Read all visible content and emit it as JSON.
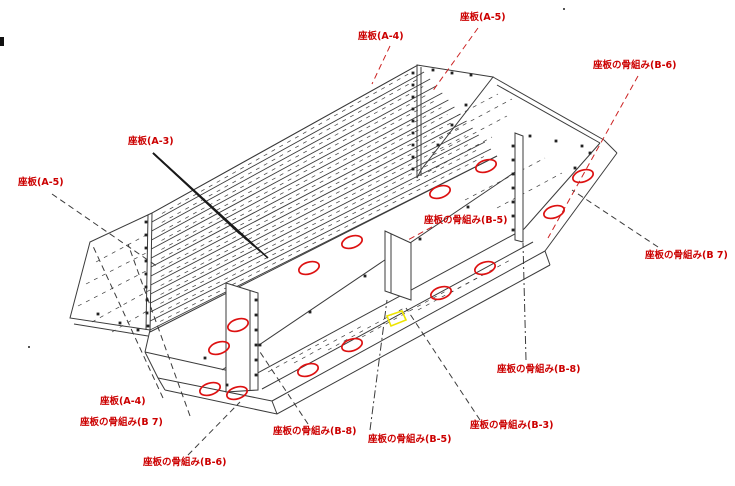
{
  "diagram": {
    "type": "isometric-assembly-drawing",
    "subject": "seat board framework assembly",
    "background": "#ffffff"
  },
  "colors": {
    "line": "#3b3b3b",
    "label": "#cc0000",
    "leader_red": "#cc2222",
    "ellipse": "#dd1111",
    "highlight": "#ede400"
  },
  "labels": [
    {
      "id": "zaban-a4-top",
      "text": "座板(A-4)",
      "x": 358,
      "y": 31
    },
    {
      "id": "zaban-a5-top",
      "text": "座板(A-5)",
      "x": 460,
      "y": 12
    },
    {
      "id": "honegumi-b6-top",
      "text": "座板の骨組み(B-6)",
      "x": 593,
      "y": 60
    },
    {
      "id": "zaban-a3",
      "text": "座板(A-3)",
      "x": 128,
      "y": 136
    },
    {
      "id": "zaban-a5-left",
      "text": "座板(A-5)",
      "x": 18,
      "y": 177
    },
    {
      "id": "honegumi-b5-top",
      "text": "座板の骨組み(B-5)",
      "x": 424,
      "y": 215
    },
    {
      "id": "honegumi-b7-right",
      "text": "座板の骨組み(B 7)",
      "x": 645,
      "y": 250
    },
    {
      "id": "honegumi-b8-right",
      "text": "座板の骨組み(B-8)",
      "x": 497,
      "y": 364
    },
    {
      "id": "zaban-a4-bottom",
      "text": "座板(A-4)",
      "x": 100,
      "y": 396
    },
    {
      "id": "honegumi-b7-bottom",
      "text": "座板の骨組み(B 7)",
      "x": 80,
      "y": 417
    },
    {
      "id": "honegumi-b6-bottom",
      "text": "座板の骨組み(B-6)",
      "x": 143,
      "y": 457
    },
    {
      "id": "honegumi-b8-bottom",
      "text": "座板の骨組み(B-8)",
      "x": 273,
      "y": 426
    },
    {
      "id": "honegumi-b5-bottom",
      "text": "座板の骨組み(B-5)",
      "x": 368,
      "y": 434
    },
    {
      "id": "honegumi-b3-bottom",
      "text": "座板の骨組み(B-3)",
      "x": 470,
      "y": 420
    }
  ],
  "leaders": [
    {
      "for": "zaban-a4-top",
      "x1": 390,
      "y1": 46,
      "x2": 372,
      "y2": 84,
      "color": "red",
      "style": "dashed"
    },
    {
      "for": "zaban-a5-top",
      "x1": 478,
      "y1": 28,
      "x2": 432,
      "y2": 92,
      "color": "red",
      "style": "dashed"
    },
    {
      "for": "honegumi-b6-top",
      "x1": 638,
      "y1": 76,
      "x2": 548,
      "y2": 238,
      "color": "red",
      "style": "dashed"
    },
    {
      "for": "honegumi-b5-top",
      "x1": 432,
      "y1": 227,
      "x2": 406,
      "y2": 241,
      "color": "red",
      "style": "dashed"
    },
    {
      "for": "zaban-a5-left",
      "x1": 52,
      "y1": 194,
      "x2": 158,
      "y2": 267,
      "color": "black",
      "style": "dashed"
    },
    {
      "for": "honegumi-b7-right",
      "x1": 658,
      "y1": 247,
      "x2": 572,
      "y2": 190,
      "color": "black",
      "style": "dashed"
    },
    {
      "for": "honegumi-b8-right",
      "x1": 526,
      "y1": 360,
      "x2": 523,
      "y2": 243,
      "color": "black",
      "style": "dashdot"
    },
    {
      "for": "zaban-a4-bottom",
      "x1": 163,
      "y1": 398,
      "x2": 92,
      "y2": 244,
      "color": "black",
      "style": "dashed"
    },
    {
      "for": "honegumi-b7-bottom",
      "x1": 190,
      "y1": 416,
      "x2": 128,
      "y2": 244,
      "color": "black",
      "style": "dashed"
    },
    {
      "for": "honegumi-b6-bottom",
      "x1": 188,
      "y1": 455,
      "x2": 240,
      "y2": 402,
      "color": "black",
      "style": "dashed"
    },
    {
      "for": "honegumi-b8-bottom",
      "x1": 308,
      "y1": 424,
      "x2": 260,
      "y2": 352,
      "color": "black",
      "style": "dashed"
    },
    {
      "for": "honegumi-b5-bottom",
      "x1": 370,
      "y1": 430,
      "x2": 387,
      "y2": 300,
      "color": "black",
      "style": "dashdot"
    },
    {
      "for": "honegumi-b3-bottom",
      "x1": 480,
      "y1": 420,
      "x2": 406,
      "y2": 308,
      "color": "black",
      "style": "dashed"
    }
  ],
  "fan_leader": {
    "for": "zaban-a3",
    "from": [
      153,
      153
    ],
    "tips": [
      [
        240,
        234
      ],
      [
        247,
        240
      ],
      [
        254,
        246
      ],
      [
        261,
        252
      ],
      [
        268,
        258
      ]
    ]
  },
  "hole_ellipses": {
    "rx": 10.5,
    "ry": 5.8,
    "rotation": -18,
    "centers": [
      [
        486,
        166
      ],
      [
        440,
        192
      ],
      [
        583,
        176
      ],
      [
        554,
        212
      ],
      [
        485,
        268
      ],
      [
        441,
        293
      ],
      [
        352,
        242
      ],
      [
        309,
        268
      ],
      [
        352,
        345
      ],
      [
        308,
        370
      ],
      [
        238,
        325
      ],
      [
        219,
        348
      ],
      [
        210,
        389
      ],
      [
        237,
        393
      ]
    ]
  },
  "highlight_quad": {
    "points": "387,316 402,311 406,320 391,326"
  },
  "slat_band": {
    "left_edge": [
      [
        152,
        213
      ],
      [
        150,
        330
      ]
    ],
    "right_edge": [
      [
        418,
        65
      ],
      [
        497,
        156
      ]
    ],
    "count": 13
  },
  "solid_paths": [
    {
      "d": "M152,213 L418,65"
    },
    {
      "d": "M152,213 L150,332"
    },
    {
      "d": "M148,215 L146,330"
    },
    {
      "d": "M150,332 L497,156"
    },
    {
      "d": "M417,65 L493,77 L421,170 L417,178 Z"
    },
    {
      "d": "M421,67 L421,176"
    },
    {
      "d": "M493,77 L604,140"
    },
    {
      "d": "M497,85 L600,143"
    },
    {
      "d": "M604,140 L617,153"
    },
    {
      "d": "M617,153 L545,251"
    },
    {
      "d": "M600,143 L524,229"
    },
    {
      "d": "M252,376 L524,229"
    },
    {
      "d": "M272,401 L545,251"
    },
    {
      "d": "M252,376 L145,352"
    },
    {
      "d": "M272,401 L158,378"
    },
    {
      "d": "M165,390 L277,414 L550,265"
    },
    {
      "d": "M158,378 L165,390"
    },
    {
      "d": "M272,401 L277,414"
    },
    {
      "d": "M545,251 L550,265"
    },
    {
      "d": "M152,213 L90,242 L70,318 L150,330"
    },
    {
      "d": "M74,324 L148,336"
    },
    {
      "d": "M150,330 L145,352"
    },
    {
      "d": "M145,352 L158,378"
    },
    {
      "d": "M222,370 L515,172"
    },
    {
      "d": "M262,389 L533,242"
    },
    {
      "d": "M226,283 L258,293 L258,390 L226,392 Z",
      "fill": "#ffffff"
    },
    {
      "d": "M250,291 L250,391"
    },
    {
      "d": "M385,231 L411,243 L411,300 L385,291 Z",
      "fill": "#ffffff"
    },
    {
      "d": "M391,234 L391,293"
    },
    {
      "d": "M515,133 L523,136 L523,242 L515,240 Z",
      "fill": "#ffffff"
    }
  ],
  "dash_segments": [
    [
      96,
      262,
      148,
      234
    ],
    [
      86,
      284,
      148,
      252
    ],
    [
      78,
      306,
      148,
      270
    ],
    [
      92,
      322,
      150,
      290
    ],
    [
      112,
      332,
      152,
      308
    ],
    [
      428,
      172,
      492,
      137
    ],
    [
      433,
      155,
      507,
      116
    ],
    [
      439,
      138,
      512,
      99
    ],
    [
      449,
      120,
      498,
      94
    ],
    [
      465,
      200,
      545,
      158
    ],
    [
      497,
      208,
      562,
      173
    ],
    [
      268,
      372,
      328,
      339
    ],
    [
      294,
      363,
      362,
      326
    ],
    [
      328,
      350,
      404,
      308
    ],
    [
      362,
      337,
      446,
      291
    ],
    [
      418,
      310,
      488,
      272
    ],
    [
      450,
      293,
      512,
      259
    ]
  ],
  "dots": [
    [
      413,
      73
    ],
    [
      413,
      85
    ],
    [
      413,
      97
    ],
    [
      413,
      109
    ],
    [
      413,
      121
    ],
    [
      413,
      133
    ],
    [
      413,
      145
    ],
    [
      413,
      157
    ],
    [
      413,
      169
    ],
    [
      433,
      70
    ],
    [
      452,
      73
    ],
    [
      471,
      75
    ],
    [
      466,
      105
    ],
    [
      452,
      125
    ],
    [
      438,
      145
    ],
    [
      530,
      136
    ],
    [
      556,
      141
    ],
    [
      582,
      146
    ],
    [
      146,
      222
    ],
    [
      146,
      235
    ],
    [
      146,
      248
    ],
    [
      146,
      261
    ],
    [
      146,
      274
    ],
    [
      146,
      287
    ],
    [
      147,
      300
    ],
    [
      147,
      313
    ],
    [
      148,
      326
    ],
    [
      98,
      314
    ],
    [
      120,
      323
    ],
    [
      138,
      330
    ],
    [
      205,
      358
    ],
    [
      227,
      385
    ],
    [
      260,
      345
    ],
    [
      310,
      312
    ],
    [
      365,
      276
    ],
    [
      420,
      239
    ],
    [
      468,
      207
    ],
    [
      513,
      146
    ],
    [
      513,
      160
    ],
    [
      513,
      174
    ],
    [
      513,
      188
    ],
    [
      513,
      202
    ],
    [
      513,
      216
    ],
    [
      513,
      230
    ],
    [
      256,
      300
    ],
    [
      256,
      315
    ],
    [
      256,
      330
    ],
    [
      256,
      345
    ],
    [
      256,
      360
    ],
    [
      256,
      375
    ],
    [
      575,
      168
    ],
    [
      590,
      153
    ]
  ],
  "artifacts": {
    "edge_mark": {
      "x": 0,
      "y": 37,
      "w": 4,
      "h": 9
    },
    "specks": [
      [
        28,
        346
      ],
      [
        563,
        8
      ]
    ]
  }
}
